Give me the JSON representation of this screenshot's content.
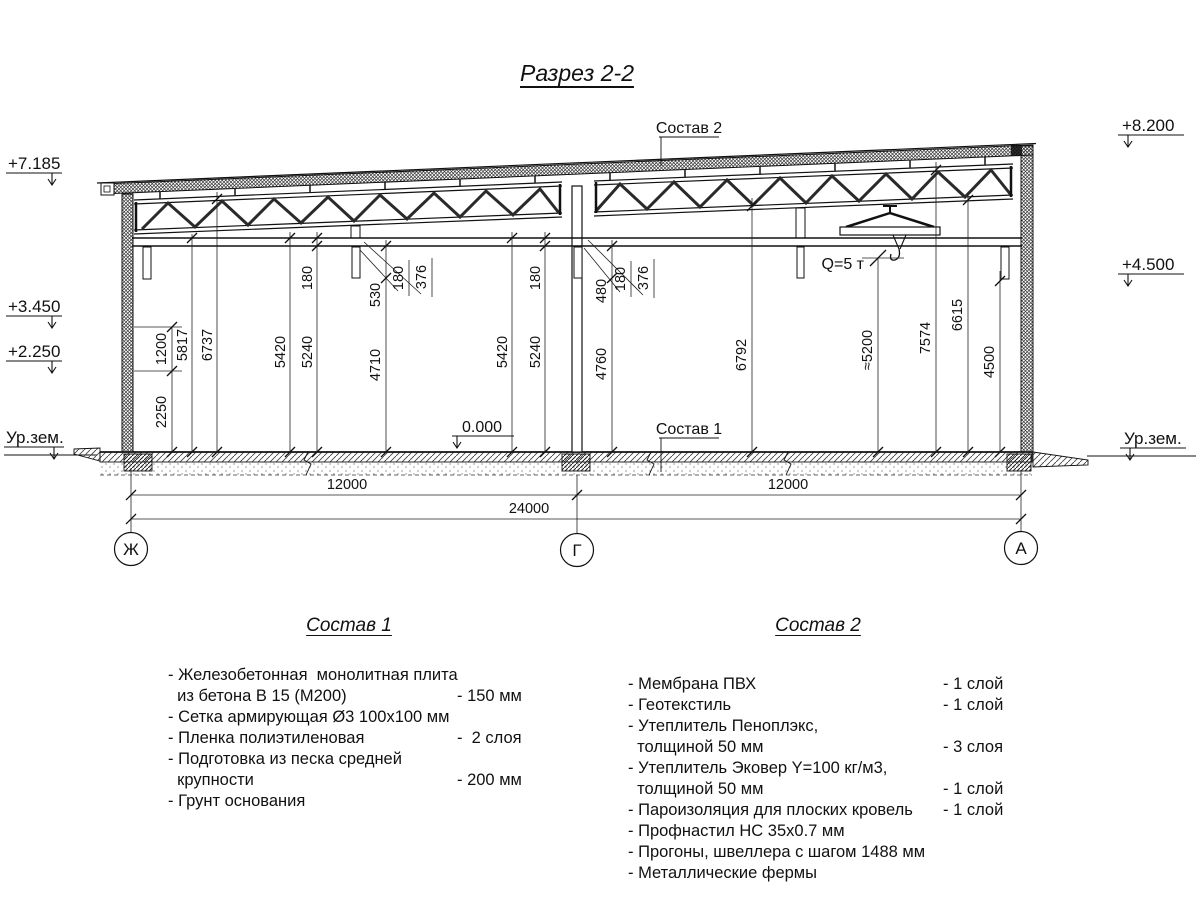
{
  "title": "Разрез 2-2",
  "elevations": {
    "p7185": "+7.185",
    "p3450": "+3.450",
    "p2250": "+2.250",
    "groundLeft": "Ур.зем.",
    "p8200": "+8.200",
    "p4500": "+4.500",
    "groundRight": "Ур.зем."
  },
  "callouts": {
    "sostav2": "Состав 2",
    "sostav1": "Состав 1",
    "zero": "0.000",
    "crane": "Q=5 т"
  },
  "vdims": {
    "v1200": "1200",
    "v2250": "2250",
    "v5817": "5817",
    "v6737": "6737",
    "v5420L": "5420",
    "v5240L": "5240",
    "v180L": "180",
    "v530": "530",
    "v4710": "4710",
    "c180L": "180",
    "c376L": "376",
    "v5420C": "5420",
    "v5240C": "5240",
    "v180C": "180",
    "v480": "480",
    "v4760": "4760",
    "c180C": "180",
    "c376C": "376",
    "v6792": "6792",
    "v5200": "≈5200",
    "v7574": "7574",
    "v6615": "6615",
    "v4500": "4500"
  },
  "hdims": {
    "bay1": "12000",
    "bay2": "12000",
    "total": "24000"
  },
  "grid": {
    "zh": "Ж",
    "g": "Г",
    "a": "А"
  },
  "sostav1": {
    "title": "Состав 1",
    "rows": [
      {
        "text": "- Железобетонная  монолитная плита",
        "value": ""
      },
      {
        "text": "  из бетона В 15 (М200)",
        "value": "- 150 мм"
      },
      {
        "text": "- Сетка армирующая Ø3 100x100 мм",
        "value": ""
      },
      {
        "text": "- Пленка полиэтиленовая",
        "value": "-  2 слоя"
      },
      {
        "text": "- Подготовка из песка средней",
        "value": ""
      },
      {
        "text": "  крупности",
        "value": "- 200 мм"
      },
      {
        "text": "- Грунт основания",
        "value": ""
      }
    ]
  },
  "sostav2": {
    "title": "Состав 2",
    "rows": [
      {
        "text": "- Мембрана ПВХ",
        "value": "- 1 слой"
      },
      {
        "text": "- Геотекстиль",
        "value": "- 1 слой"
      },
      {
        "text": "- Утеплитель Пеноплэкс,",
        "value": ""
      },
      {
        "text": "  толщиной 50 мм",
        "value": "- 3 слоя"
      },
      {
        "text": "- Утеплитель Эковер Y=100 кг/м3,",
        "value": ""
      },
      {
        "text": "  толщиной 50 мм",
        "value": "- 1 слой"
      },
      {
        "text": "- Пароизоляция для плоских кровель",
        "value": "- 1 слой"
      },
      {
        "text": "- Профнастил НС 35x0.7 мм",
        "value": ""
      },
      {
        "text": "- Прогоны, швеллера с шагом 1488 мм",
        "value": ""
      },
      {
        "text": "- Металлические фермы",
        "value": ""
      }
    ]
  }
}
